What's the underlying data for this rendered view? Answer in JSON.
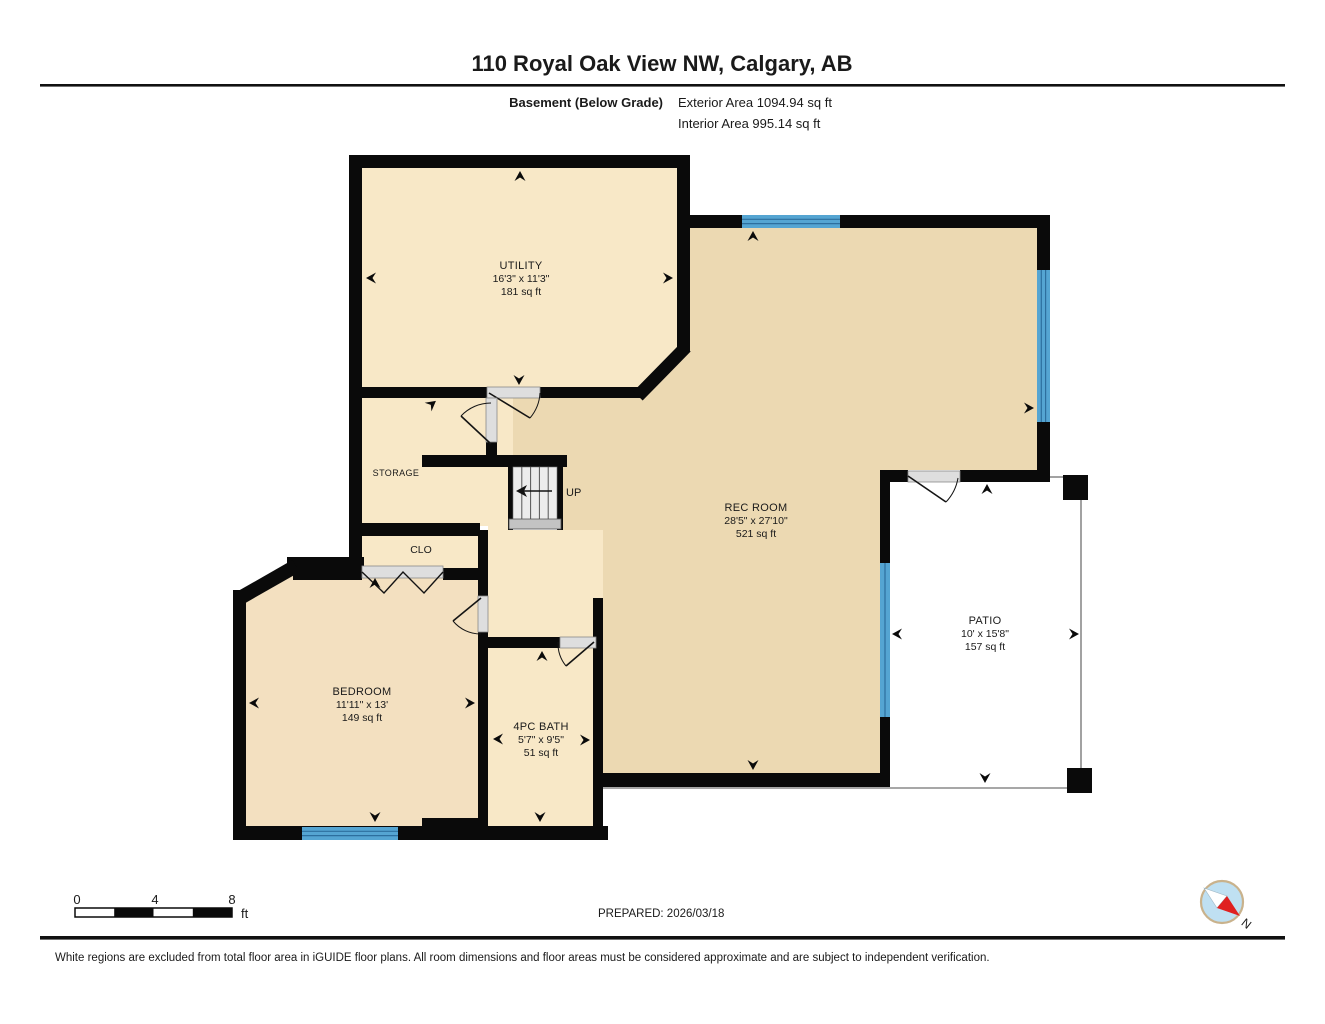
{
  "title": "110 Royal Oak View NW, Calgary, AB",
  "header": {
    "floor_label": "Basement (Below Grade)",
    "exterior_area": "Exterior Area 1094.94 sq ft",
    "interior_area": "Interior Area 995.14 sq ft"
  },
  "rooms": {
    "utility": {
      "name": "UTILITY",
      "dimensions": "16'3\" x 11'3\"",
      "area": "181 sq ft"
    },
    "rec_room": {
      "name": "REC ROOM",
      "dimensions": "28'5\" x 27'10\"",
      "area": "521 sq ft"
    },
    "bedroom": {
      "name": "BEDROOM",
      "dimensions": "11'11\" x 13'",
      "area": "149 sq ft"
    },
    "bath": {
      "name": "4PC BATH",
      "dimensions": "5'7\" x 9'5\"",
      "area": "51 sq ft"
    },
    "patio": {
      "name": "PATIO",
      "dimensions": "10' x 15'8\"",
      "area": "157 sq ft"
    },
    "storage": {
      "name": "STORAGE"
    },
    "closet": {
      "name": "CLO"
    },
    "stairs": {
      "label": "UP"
    }
  },
  "scale_bar": {
    "tick0": "0",
    "tick4": "4",
    "tick8": "8",
    "unit": "ft"
  },
  "footer": {
    "prepared": "PREPARED: 2026/03/18",
    "disclaimer": "White regions are excluded from total floor area in iGUIDE floor plans. All room dimensions and floor areas must be considered approximate and are subject to independent verification.",
    "compass_north": "N"
  },
  "colors": {
    "wall": "#0a0a0a",
    "room_light": "#f8e8c7",
    "rec_room_fill": "#ecd9b2",
    "bedroom_fill": "#f3e0c0",
    "window": "#55a5d2",
    "window_line": "#2d6f9e",
    "door_gray": "#dedede",
    "stair_gray": "#ececec",
    "patio_outline": "#8a8a8a",
    "compass_blue": "#bfe0f2",
    "compass_red": "#e02020"
  }
}
